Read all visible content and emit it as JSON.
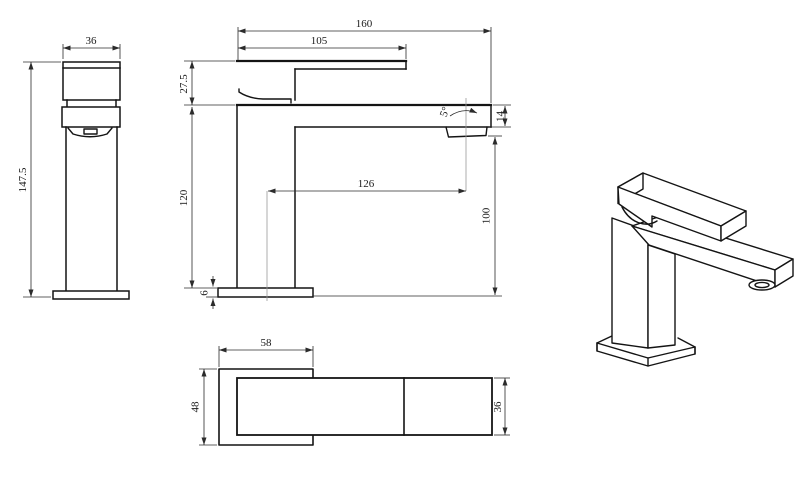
{
  "colors": {
    "background": "#ffffff",
    "object_line": "#141414",
    "dimension_line": "#2b2b2b",
    "centerline": "#9a9a9a"
  },
  "views": {
    "front": {
      "dims": {
        "handle_width": "36",
        "overall_height": "147.5"
      }
    },
    "side": {
      "dims": {
        "overall_length": "160",
        "handle_length": "105",
        "handle_height": "27.5",
        "body_height": "120",
        "base_thickness": "6",
        "spout_reach": "126",
        "outlet_height": "100",
        "spout_end_height": "14",
        "spout_angle": "5°"
      }
    },
    "top": {
      "dims": {
        "base_length": "58",
        "base_depth": "48",
        "spout_width": "36"
      }
    }
  }
}
